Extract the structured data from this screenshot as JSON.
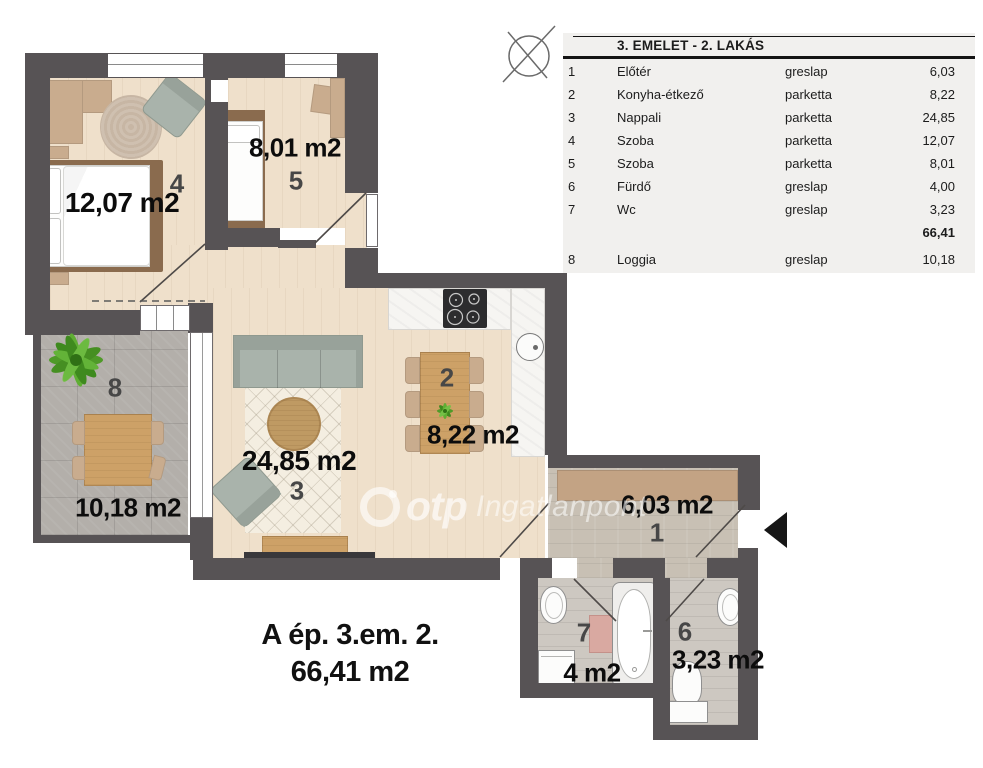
{
  "legend": {
    "title": "3. EMELET - 2. LAKÁS",
    "rows": [
      {
        "num": "1",
        "name": "Előtér",
        "finish": "greslap",
        "area": "6,03"
      },
      {
        "num": "2",
        "name": "Konyha-étkező",
        "finish": "parketta",
        "area": "8,22"
      },
      {
        "num": "3",
        "name": "Nappali",
        "finish": "parketta",
        "area": "24,85"
      },
      {
        "num": "4",
        "name": "Szoba",
        "finish": "parketta",
        "area": "12,07"
      },
      {
        "num": "5",
        "name": "Szoba",
        "finish": "parketta",
        "area": "8,01"
      },
      {
        "num": "6",
        "name": "Fürdő",
        "finish": "greslap",
        "area": "4,00"
      },
      {
        "num": "7",
        "name": "Wc",
        "finish": "greslap",
        "area": "3,23"
      }
    ],
    "total": "66,41",
    "extra_row": {
      "num": "8",
      "name": "Loggia",
      "finish": "greslap",
      "area": "10,18"
    }
  },
  "plan": {
    "rooms": {
      "room1": {
        "num": "1",
        "area": "6,03 m2"
      },
      "room2": {
        "num": "2",
        "area": "8,22 m2"
      },
      "room3": {
        "num": "3",
        "area": "24,85 m2"
      },
      "room4": {
        "num": "4",
        "area": "12,07 m2"
      },
      "room5": {
        "num": "5",
        "area": "8,01 m2"
      },
      "room6": {
        "num": "6",
        "area": "3,23 m2"
      },
      "room7": {
        "num": "7",
        "area": "4 m2"
      },
      "room8": {
        "num": "8",
        "area": "10,18 m2"
      }
    }
  },
  "footer": {
    "line1": "A ép. 3.em. 2.",
    "line2": "66,41 m2"
  },
  "watermark": {
    "brand": "otp",
    "suffix": "Ingatlanpont"
  },
  "colors": {
    "wall": "#575355",
    "wood_floor": "#efe0cb",
    "loggia_tile": "#b3afaa",
    "entry_tile": "#c8c0b4",
    "bath_tile": "#cdc8c1",
    "wardrobe_beige": "#c9ac8e",
    "sofa_green": "#a9b3ab",
    "table_wood": "#cda167",
    "mat_pink": "#d9a9a1"
  }
}
